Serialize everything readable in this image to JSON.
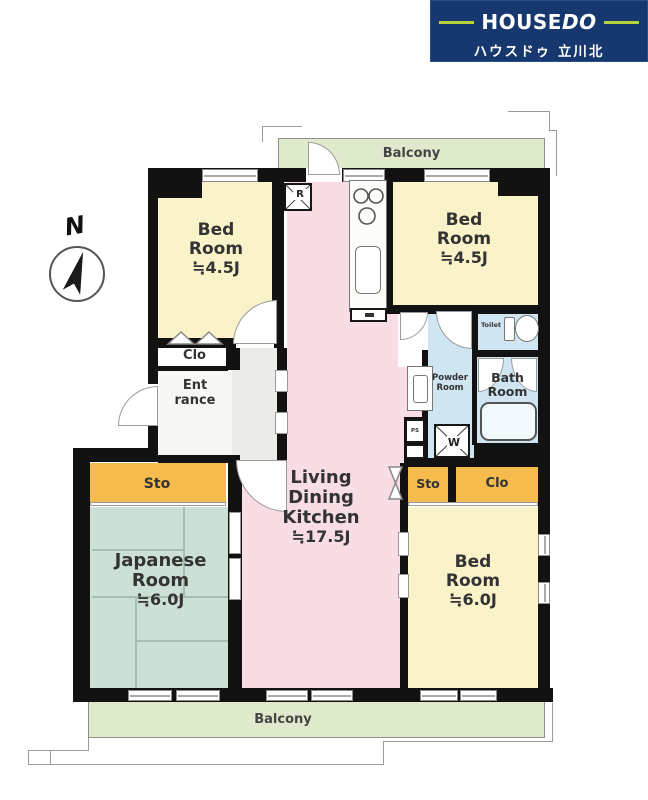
{
  "header": {
    "brand_house": "HOUSE",
    "brand_do": "DO",
    "branch_name": "ハウスドゥ 立川北"
  },
  "compass": {
    "north_label": "N"
  },
  "balcony": {
    "top_label": "Balcony",
    "bottom_label": "Balcony"
  },
  "rooms": {
    "bedroom_nw": {
      "line1": "Bed",
      "line2": "Room",
      "size": "≒4.5J"
    },
    "bedroom_ne": {
      "line1": "Bed",
      "line2": "Room",
      "size": "≒4.5J"
    },
    "bedroom_se": {
      "line1": "Bed",
      "line2": "Room",
      "size": "≒6.0J"
    },
    "japanese_room": {
      "line1": "Japanese",
      "line2": "Room",
      "size": "≒6.0J"
    },
    "ldk": {
      "line1": "Living",
      "line2": "Dining",
      "line3": "Kitchen",
      "size": "≒17.5J"
    },
    "entrance": {
      "line1": "Ent",
      "line2": "rance"
    },
    "powder_room": {
      "line1": "Powder",
      "line2": "Room"
    },
    "bath_room": {
      "line1": "Bath",
      "line2": "Room"
    },
    "toilet": {
      "label": "Toilet"
    }
  },
  "storage": {
    "closet_nw": "Clo",
    "storage_w": "Sto",
    "storage_e": "Sto",
    "closet_e": "Clo"
  },
  "fixtures": {
    "refrigerator_label": "R",
    "washer_label": "W",
    "pipe_space_label": "PS"
  },
  "colors": {
    "wall": "#121212",
    "bedroom_fill": "#faf3c9",
    "ldk_fill": "#f9dde4",
    "tatami_fill": "#cde0d6",
    "balcony_fill": "#dfe9cb",
    "storage_fill": "#f6bb4d",
    "water_fill": "#cfe6f2",
    "header_bg": "#17386f",
    "header_accent": "#b5d437"
  }
}
